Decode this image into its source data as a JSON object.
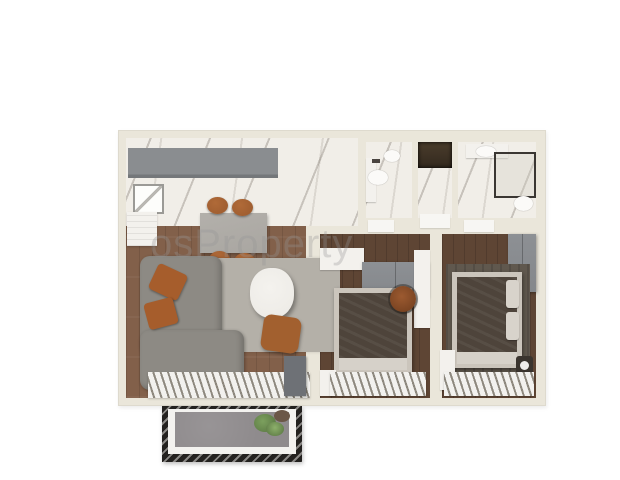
{
  "watermark": {
    "prefix": "os",
    "text": "Property"
  },
  "colors": {
    "wall": "#eae6da",
    "marble": "#f1eee8",
    "wood_living": "#82604a",
    "wood_bedroom": "#5e4534",
    "cabinet_gray": "#8a8d90",
    "counter_white": "#f3f1ed",
    "table_gray": "#a9a6a1",
    "chair_orange": "#9a5a2e",
    "sofa_gray": "#8d8a84",
    "pillow_orange": "#a65d2c",
    "rug_gray": "#b4b0a8",
    "coffee_table": "#eceae5",
    "pouf_orange": "#a2602f",
    "stripe_light": "#f2f1ee",
    "stripe_dark": "#8e897f",
    "tv_console": "#6e7176",
    "wardrobe_gray": "#84878b",
    "bed_mattress": "#cbc5bc",
    "bed_blanket": "#4e443b",
    "bed_sheet": "#d6d1c9",
    "dark_rug": "#60584e",
    "niche_dark": "#33291e",
    "threshold_white": "#f7f6f3",
    "balcony_frame": "#23211f",
    "balcony_floor": "#8f8b8d",
    "balcony_ledge": "#f3f2ef",
    "plant_green": "#7ca05e",
    "plant_dark": "#55713f",
    "pot_brown": "#6b5747",
    "fixture_white": "#fbfaf8",
    "shower_frame": "#3a3632",
    "watermark": "rgba(150,150,150,0.32)"
  }
}
